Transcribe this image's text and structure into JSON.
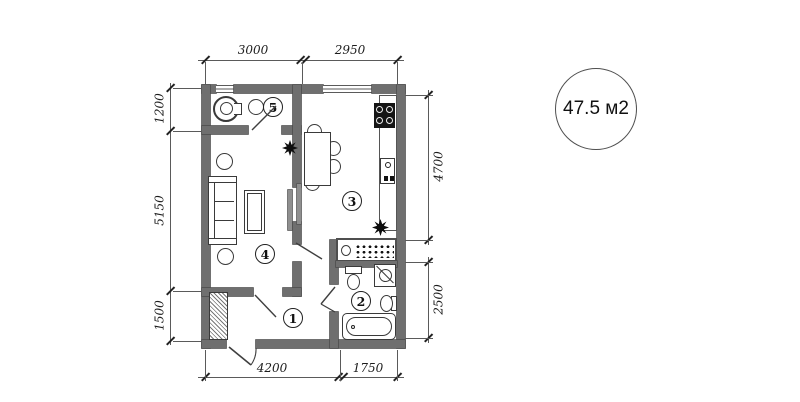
{
  "plan": {
    "area_label": "47.5 м2",
    "room_numbers": [
      "1",
      "2",
      "3",
      "4",
      "5"
    ],
    "dimensions": {
      "top": [
        "3000",
        "2950"
      ],
      "bottom": [
        "4200",
        "1750"
      ],
      "left": [
        "1200",
        "5150",
        "1500"
      ],
      "right": [
        "4700",
        "2500"
      ]
    },
    "colors": {
      "wall": "#6f6f6f",
      "wall_edge": "#4c4c4c",
      "line": "#3a3a3a",
      "dim_line": "#5a5a5a",
      "text": "#1c1c1c"
    },
    "icons": {
      "toilet": "toilet-icon",
      "sink": "sink-icon",
      "bathtub": "bathtub-icon",
      "washing_machine": "washing-machine-icon",
      "stove": "stove-icon",
      "dining_table": "dining-table",
      "sofa": "sofa",
      "coffee_table": "coffee-table",
      "stool": "stool",
      "plant": "plant-icon",
      "wardrobe": "wardrobe",
      "vent_shaft": "vent-shaft",
      "door": "door-swing"
    }
  }
}
